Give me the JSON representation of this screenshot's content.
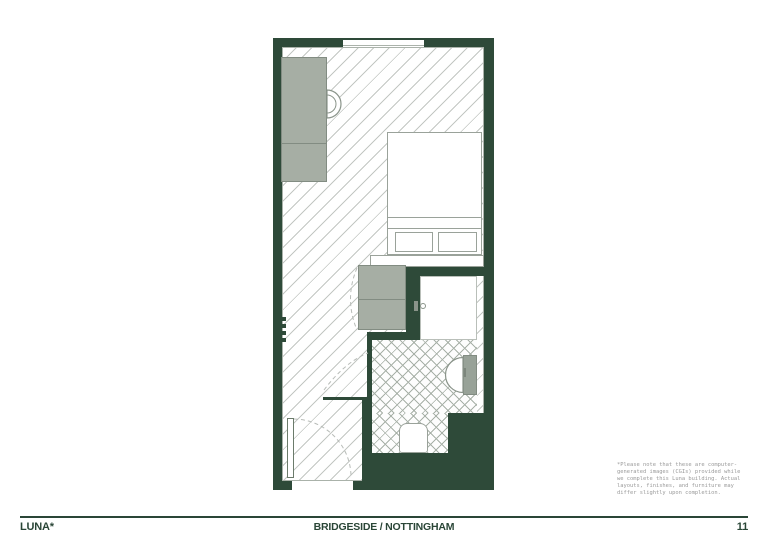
{
  "footer": {
    "brand": "LUNA*",
    "project": "BRIDGESIDE / NOTTINGHAM",
    "page": "11"
  },
  "disclaimer": {
    "lines": [
      "*Please note that these are computer-",
      "generated images (CGIs) provided while",
      "we complete this Luna building. Actual",
      "layouts, finishes, and furniture may",
      "differ slightly upon completion."
    ]
  },
  "floorplan": {
    "type": "studio-apartment-floor-plan",
    "rooms": [
      "main-studio-room",
      "bathroom",
      "entry-hall"
    ],
    "elements": [
      "window",
      "kitchenette-unit",
      "desk-chair",
      "bed",
      "pillows",
      "bed-shelf",
      "wardrobe",
      "bathroom-door",
      "door-handle",
      "sink-counter",
      "sink-basin",
      "toilet",
      "entry-door",
      "radiator",
      "door-swing-arcs"
    ],
    "colors": {
      "wall_green": "#2e4a39",
      "furniture_grey": "#a6aea4",
      "hatch_grey": "#c3c7c3",
      "tile_grey": "#a8b1a8",
      "footer_green": "#2a4637",
      "disclaimer_grey": "#9a9a9a",
      "background": "#ffffff"
    }
  }
}
